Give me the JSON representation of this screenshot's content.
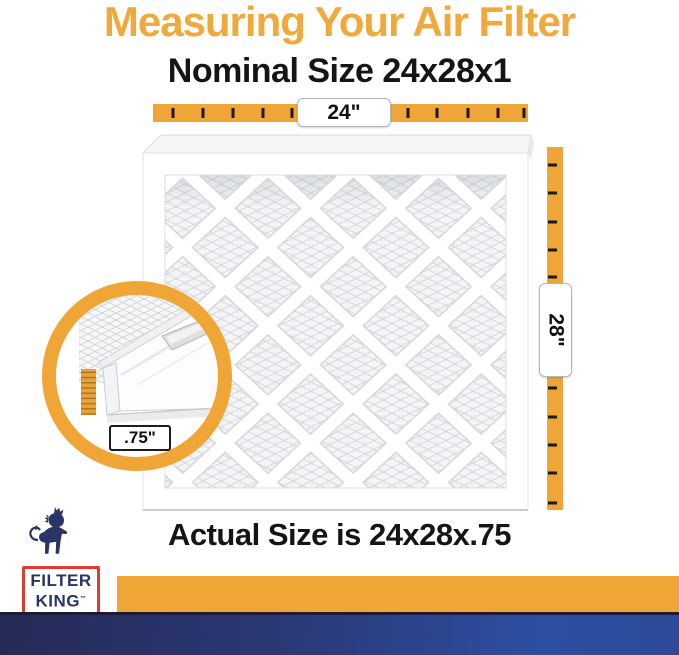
{
  "header": {
    "title": "Measuring Your Air Filter",
    "subtitle": "Nominal Size 24x28x1"
  },
  "measurements": {
    "width": "24\"",
    "height": "28\"",
    "depth": ".75\""
  },
  "caption": "Actual Size is 24x28x.75",
  "logo": {
    "line1": "FILTER",
    "line2": "KING",
    "trademark": "™"
  },
  "colors": {
    "accent_orange": "#F0A537",
    "title_orange": "#EFA93C",
    "text_black": "#151515",
    "logo_navy": "#2B3467",
    "logo_red": "#E23A2E",
    "footer_navy_left": "#262A56",
    "footer_navy_right": "#2D4FA2"
  }
}
